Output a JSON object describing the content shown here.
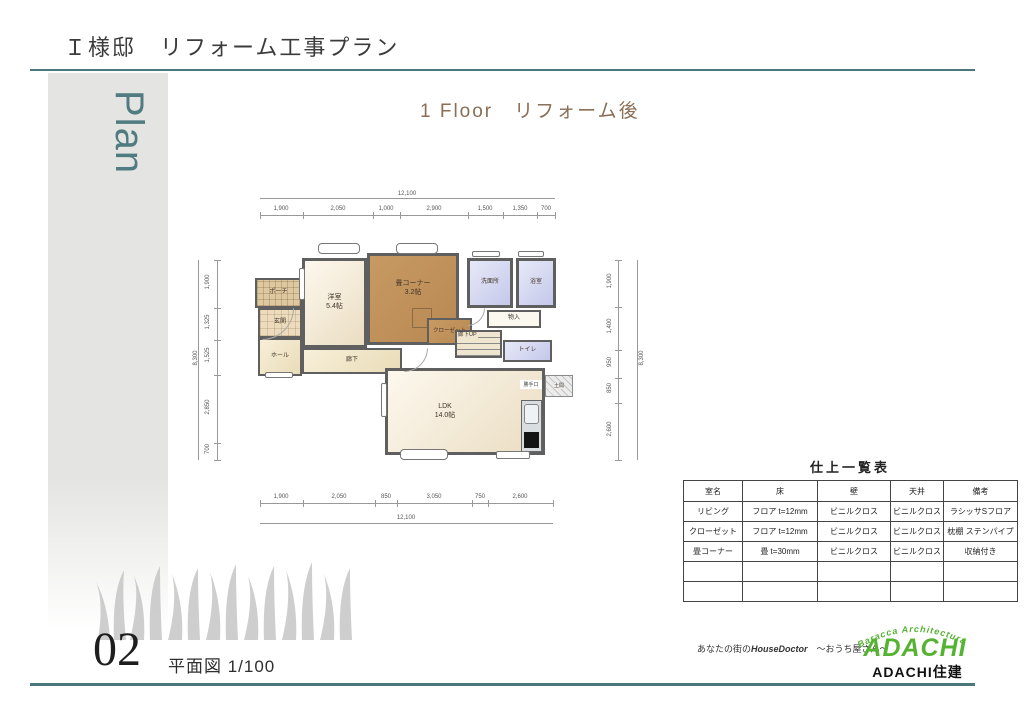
{
  "header": {
    "title": "Ｉ様邸　リフォーム工事プラン",
    "subtitle": "1 Floor　リフォーム後",
    "sidebar_label": "Plan"
  },
  "floor_plan": {
    "rooms": {
      "porch": "ポーチ",
      "entrance": "玄関",
      "hall": "ホール",
      "western_room": "洋室\n5.4帖",
      "tatami_corner": "畳コーナー\n3.2帖",
      "closet": "クローゼット",
      "washroom": "洗面所",
      "bath": "浴室",
      "storage": "物入",
      "stairs": "廊下UP",
      "toilet": "トイレ",
      "corridor": "廊下",
      "ldk": "LDK\n14.0帖",
      "back_door": "勝手口",
      "doma": "土間"
    },
    "dimensions": {
      "top": {
        "total": "12,100",
        "segments": [
          "1,900",
          "2,050",
          "1,000",
          "2,900",
          "1,500",
          "1,350",
          "700"
        ]
      },
      "bottom": {
        "total": "12,100",
        "segments": [
          "1,900",
          "2,050",
          "850",
          "3,050",
          "750",
          "2,600"
        ]
      },
      "left": {
        "total": "8,300",
        "segments": [
          "1,900",
          "1,325",
          "1,525",
          "2,850",
          "700"
        ]
      },
      "right": {
        "total": "8,300",
        "segments": [
          "1,900",
          "1,400",
          "950",
          "850",
          "2,600"
        ]
      }
    }
  },
  "finish_table": {
    "title": "仕上一覧表",
    "headers": [
      "室名",
      "床",
      "壁",
      "天井",
      "備考"
    ],
    "rows": [
      [
        "リビング",
        "フロア t=12mm",
        "ビニルクロス",
        "ビニルクロス",
        "ラシッサSフロア"
      ],
      [
        "クローゼット",
        "フロア t=12mm",
        "ビニルクロス",
        "ビニルクロス",
        "枕棚 ステンパイプ"
      ],
      [
        "畳コーナー",
        "畳 t=30mm",
        "ビニルクロス",
        "ビニルクロス",
        "収納付き"
      ],
      [
        "",
        "",
        "",
        "",
        ""
      ],
      [
        "",
        "",
        "",
        "",
        ""
      ]
    ]
  },
  "footer": {
    "page_number": "02",
    "caption": "平面図 1/100",
    "tagline_prefix": "あなたの街の",
    "tagline_brand": "HouseDoctor",
    "tagline_suffix": "　～おうち屋さん～",
    "logo_arc": "Baracca Architectura",
    "logo_name": "ADACHI",
    "logo_company": "ADACHI住建"
  },
  "colors": {
    "accent_teal": "#4b787d",
    "subtitle_brown": "#8a6e55",
    "logo_green": "#55b332",
    "tatami_brown": "#bf9059",
    "wet_room_lavender": "#ccd0ed",
    "wall_gray": "#5f5f5f"
  }
}
